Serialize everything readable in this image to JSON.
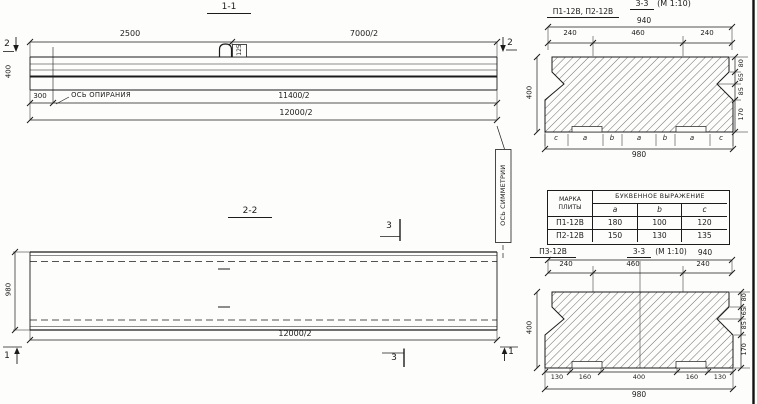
{
  "colors": {
    "ink": "#1c1c1c",
    "paper": "#fdfdfb"
  },
  "s11": {
    "title": "1-1",
    "dim_top_left": "2500",
    "dim_top_right": "7000/2",
    "dim_height": "400",
    "dim_offset": "300",
    "support_axis_label": "ОСЬ ОПИРАНИЯ",
    "dim_mid": "11400/2",
    "dim_total": "12000/2",
    "loop_label": "125",
    "mark_left": "2",
    "mark_right": "2"
  },
  "s22": {
    "title": "2-2",
    "dim_width": "980",
    "dim_total": "12000/2",
    "mark_top": "3",
    "mark_bottom": "3",
    "mark_left": "1",
    "mark_right": "1",
    "symmetry_label": "ОСЬ СИММЕТРИИ"
  },
  "cs1": {
    "label": "П1-12В, П2-12В",
    "title_main": "3-3",
    "title_scale": "(М 1:10)",
    "dim_940": "940",
    "top_dims": [
      "240",
      "460",
      "240"
    ],
    "right_dims": [
      "80",
      "65",
      "85",
      "170"
    ],
    "dim_400": "400",
    "letters": [
      "c",
      "a",
      "b",
      "a",
      "b",
      "a",
      "c"
    ],
    "dim_980": "980"
  },
  "table": {
    "col1_header_line1": "МАРКА",
    "col1_header_line2": "ПЛИТЫ",
    "span_header": "БУКВЕННОЕ ВЫРАЖЕНИЕ",
    "col_headers": [
      "a",
      "b",
      "c"
    ],
    "rows": [
      {
        "mark": "П1-12В",
        "a": "180",
        "b": "100",
        "c": "120"
      },
      {
        "mark": "П2-12В",
        "a": "150",
        "b": "130",
        "c": "135"
      }
    ]
  },
  "cs3": {
    "label": "П3-12В",
    "title_main": "3-3",
    "title_scale": "(М 1:10)",
    "dim_940": "940",
    "top_dims": [
      "240",
      "460",
      "240"
    ],
    "right_dims": [
      "80",
      "65",
      "85",
      "170"
    ],
    "dim_400": "400",
    "bottom_dims": [
      "130",
      "160",
      "400",
      "160",
      "130"
    ],
    "dim_980": "980"
  }
}
